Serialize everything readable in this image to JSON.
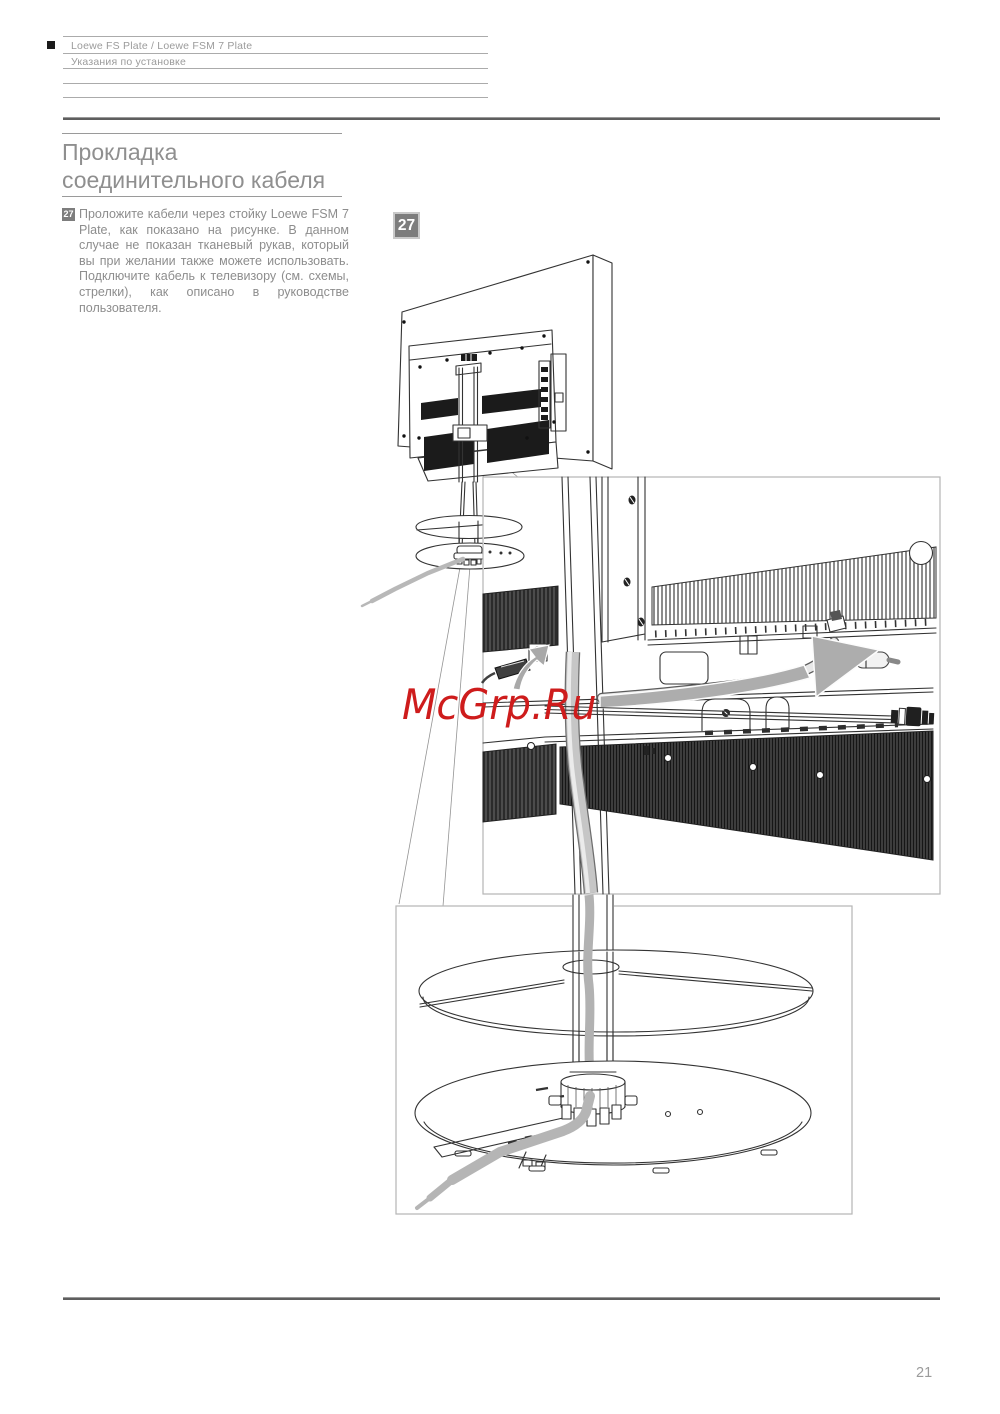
{
  "header": {
    "product_line": "Loewe FS Plate / Loewe FSM 7 Plate",
    "section_line": "Указания по установке"
  },
  "content": {
    "title": "Прокладка соединительного кабеля",
    "step": {
      "number": "27",
      "text": "Проложите кабели через стойку Loewe FSM 7 Plate, как показано на рисунке. В данном случае не показан тканевый рукав, который вы при желании также можете использовать. Подключите кабель к телевизору (см. схемы, стрелки), как описано в руководстве пользователя."
    },
    "figure": {
      "label": "27"
    }
  },
  "watermark": {
    "text": "McGrp.Ru"
  },
  "footer": {
    "page_number": "21"
  },
  "colors": {
    "step_badge_bg": "#7d7d7d",
    "figure_badge_bg": "#7d7d7d",
    "body_text": "#8d8d8d",
    "header_rule": "#ababab",
    "dark_rule": "#5e5e5e",
    "watermark_red": "#ce1c1c",
    "cable_gray": "#b8b8b8",
    "arrow_gray": "#a9a9a9"
  }
}
